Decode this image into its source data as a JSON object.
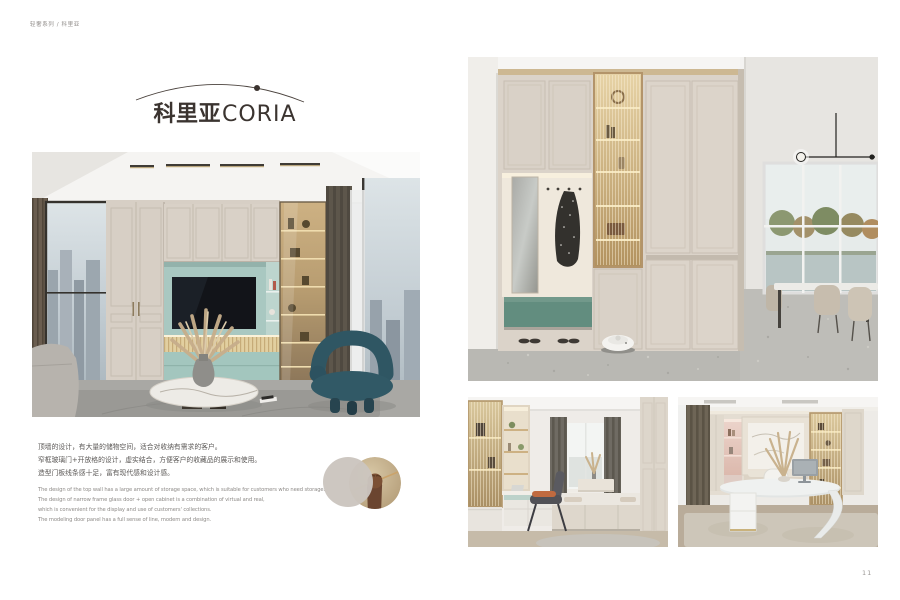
{
  "header": {
    "breadcrumb": "轻奢系列 / 科里亚"
  },
  "title": {
    "cn": "科里亚",
    "en": "CORIA"
  },
  "descriptions": {
    "cn": [
      "顶墙的设计，有大量的储物空间，适合对收纳有需求的客户。",
      "窄框玻璃门+开放格的设计，虚实结合，方便客户的收藏品的展示和使用。",
      "造型门板线条感十足，富有现代感和设计感。"
    ],
    "en": [
      "The design of the top wall has a large amount of storage space, which is suitable for customers who need storage.",
      "The design of narrow frame glass door + open cabinet is a combination of virtual and real,",
      "which is convenient for the display and use of customers' collections.",
      "The modeling door panel has a full sense of line, modern and design."
    ]
  },
  "page_number": "11",
  "palette": {
    "title_ink": "#3b3430",
    "cabinet_beige": "#d7cfc5",
    "tv_niche_teal": "#a9c8c1",
    "base_teal": "#a3c6be",
    "bench_green": "#628d7f",
    "glass_warm": "#cdb183",
    "circle_beige": "#cbc5be"
  }
}
